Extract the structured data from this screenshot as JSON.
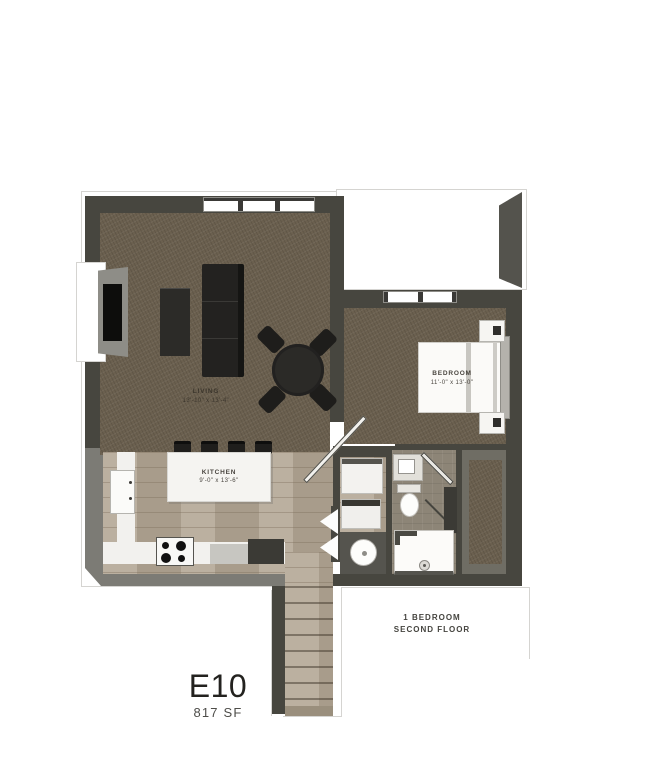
{
  "unit": {
    "code": "E10",
    "area": "817 SF"
  },
  "note": {
    "line1": "1 BEDROOM",
    "line2": "SECOND FLOOR"
  },
  "rooms": {
    "living": {
      "name": "LIVING",
      "dims": "13'-10\" x 13'-4\""
    },
    "kitchen": {
      "name": "KITCHEN",
      "dims": "9'-0\" x 13'-6\""
    },
    "bedroom": {
      "name": "BEDROOM",
      "dims": "11'-0\" x 13'-0\""
    }
  },
  "colors": {
    "wall": "#47463f",
    "wall-light": "#7c7b75",
    "carpet": "#6b604f",
    "wood": "#b3a795",
    "tile": "#8d8577",
    "outline": "#d5d4d1",
    "furniture-dark": "#232220"
  }
}
